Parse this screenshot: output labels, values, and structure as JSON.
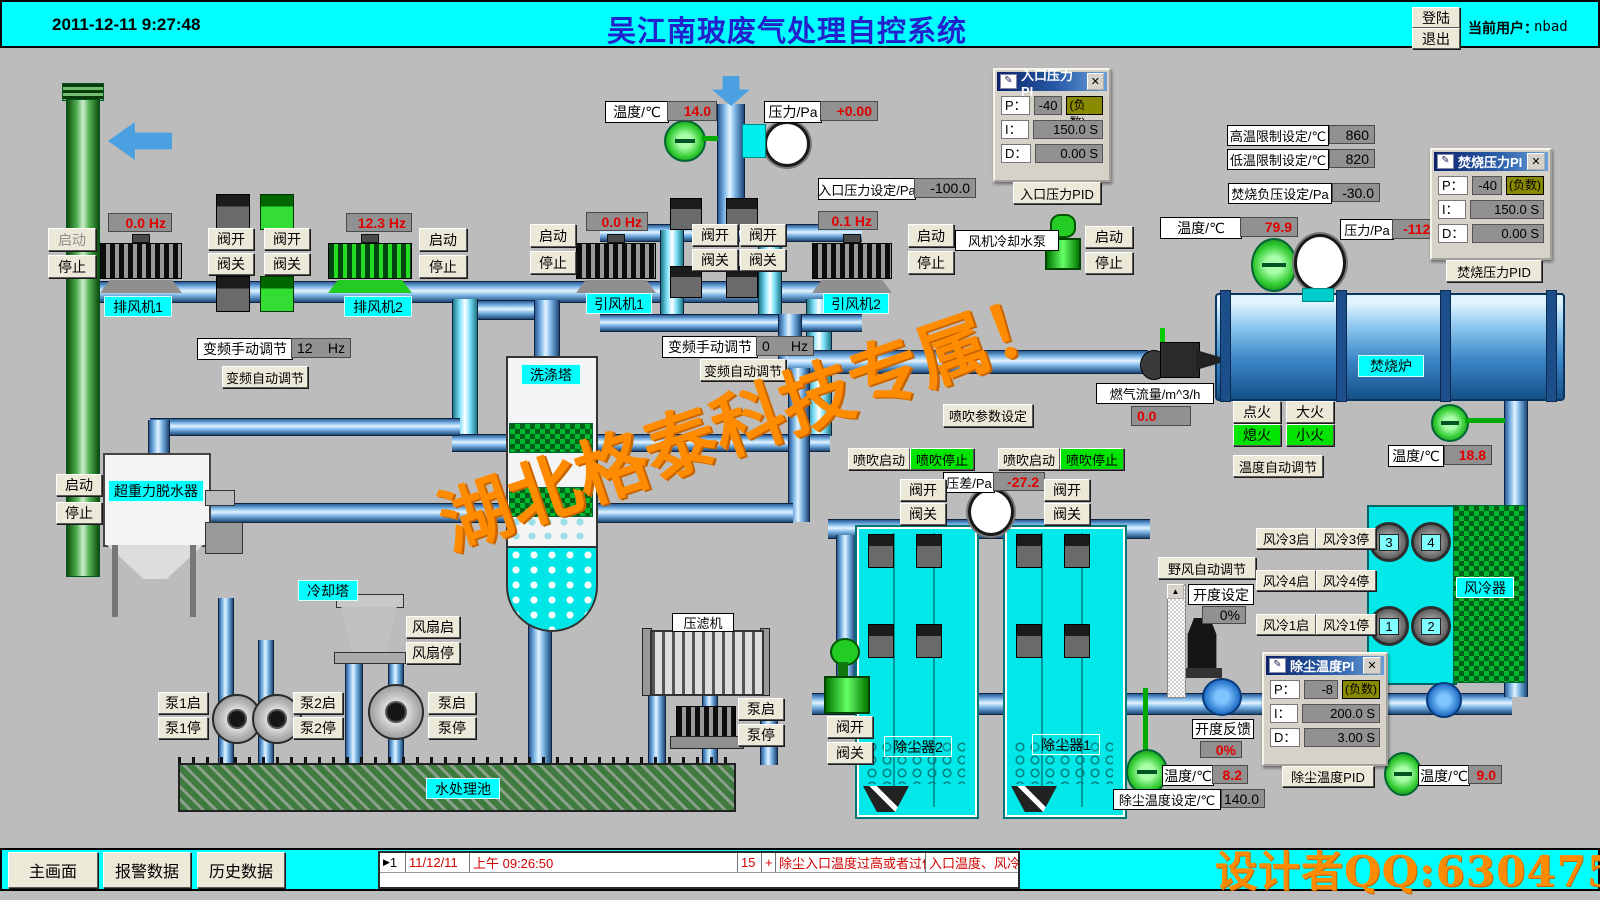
{
  "icons": {
    "pid_doc": "✎",
    "close": "✕",
    "up": "▲",
    "marker": "▶"
  },
  "common": {
    "start": "启动",
    "stop": "停止",
    "valve_open": "阀开",
    "valve_close": "阀关",
    "pump_start": "泵启",
    "pump_stop": "泵停",
    "neg": "(负数)",
    "p": "P：",
    "i": "I：",
    "d": "D："
  },
  "header": {
    "date": "2011-12-11 9:27:48",
    "title": "吴江南玻废气处理自控系统",
    "login": "登陆",
    "logout": "退出",
    "user_label": "当前用户：",
    "user": "nbad"
  },
  "exhaust": {
    "hz1": "0.0 Hz",
    "hz2": "12.3 Hz",
    "fan1": "排风机1",
    "fan2": "排风机2",
    "vfd_label": "变频手动调节",
    "vfd_value": "12",
    "vfd_unit": "Hz",
    "vfd_auto": "变频自动调节"
  },
  "induced": {
    "temp_label": "温度/℃",
    "temp": "14.0",
    "pres_label": "压力/Pa",
    "pres": "+0.00",
    "inlet_set_label": "入口压力设定/Pa",
    "inlet_set": "-100.0",
    "hz1": "0.0 Hz",
    "hz2": "0.1 Hz",
    "fan1": "引风机1",
    "fan2": "引风机2",
    "vfd_label": "变频手动调节",
    "vfd_value": "0",
    "vfd_unit": "Hz",
    "vfd_auto": "变频自动调节",
    "cooling_pump": "风机冷却水泵"
  },
  "pid_inlet": {
    "title": "入口压力PI",
    "p": "-40",
    "i": "150.0 S",
    "d": "0.00 S",
    "btn": "入口压力PID"
  },
  "pid_burn": {
    "title": "焚烧压力PI",
    "p": "-40",
    "i": "150.0 S",
    "d": "0.00 S",
    "btn": "焚烧压力PID"
  },
  "pid_dust": {
    "title": "除尘温度PI",
    "p": "-8",
    "i": "200.0 S",
    "d": "3.00 S",
    "btn": "除尘温度PID"
  },
  "furnace": {
    "high_label": "高温限制设定/℃",
    "high": "860",
    "low_label": "低温限制设定/℃",
    "low": "820",
    "negp_label": "焚烧负压设定/Pa",
    "negp": "-30.0",
    "temp_label": "温度/℃",
    "temp": "79.9",
    "pres_label": "压力/Pa",
    "pres": "-112.6",
    "name": "焚烧炉",
    "gas_label": "燃气流量/m^3/h",
    "gas": "0.0",
    "ignite": "点火",
    "big_fire": "大火",
    "off_fire": "熄火",
    "small_fire": "小火",
    "temp_auto": "温度自动调节",
    "out_temp_label": "温度/℃",
    "out_temp": "18.8"
  },
  "blow": {
    "param": "喷吹参数设定",
    "start": "喷吹启动",
    "stop": "喷吹停止",
    "dp_label": "压差/Pa",
    "dp": "-27.2"
  },
  "left": {
    "dehydrator": "超重力脱水器",
    "scrubber": "洗涤塔",
    "cooling": "冷却塔",
    "fan_start": "风扇启",
    "fan_stop": "风扇停",
    "pool": "水处理池",
    "press": "压滤机",
    "p1s": "泵1启",
    "p1e": "泵1停",
    "p2s": "泵2启",
    "p2e": "泵2停"
  },
  "dust": {
    "t2": "除尘器2",
    "t1": "除尘器1",
    "wild": "野风自动调节",
    "open_label": "开度设定",
    "open_value": "0%",
    "fb_label": "开度反馈",
    "fb": "0%",
    "in_temp_label": "温度/℃",
    "in_temp": "8.2",
    "set_label": "除尘温度设定/℃",
    "set": "140.0",
    "out_temp_label": "温度/℃",
    "out_temp": "9.0"
  },
  "aircool": {
    "name": "风冷器",
    "b3s": "风冷3启",
    "b3e": "风冷3停",
    "b4s": "风冷4启",
    "b4e": "风冷4停",
    "b1s": "风冷1启",
    "b1e": "风冷1停",
    "f3": "3",
    "f4": "4",
    "f1": "1",
    "f2": "2"
  },
  "footer": {
    "main": "主画面",
    "alarm": "报警数据",
    "history": "历史数据",
    "row": {
      "num": "1",
      "date": "11/12/11",
      "time": "上午 09:26:50",
      "code": "15",
      "plus": "+",
      "msg": "除尘入口温度过高或者过低",
      "detail": "入口温度、风冷、野风"
    }
  },
  "watermark": {
    "big": "湖北格泰科技专属！",
    "qq": "设计者QQ:6304753"
  }
}
